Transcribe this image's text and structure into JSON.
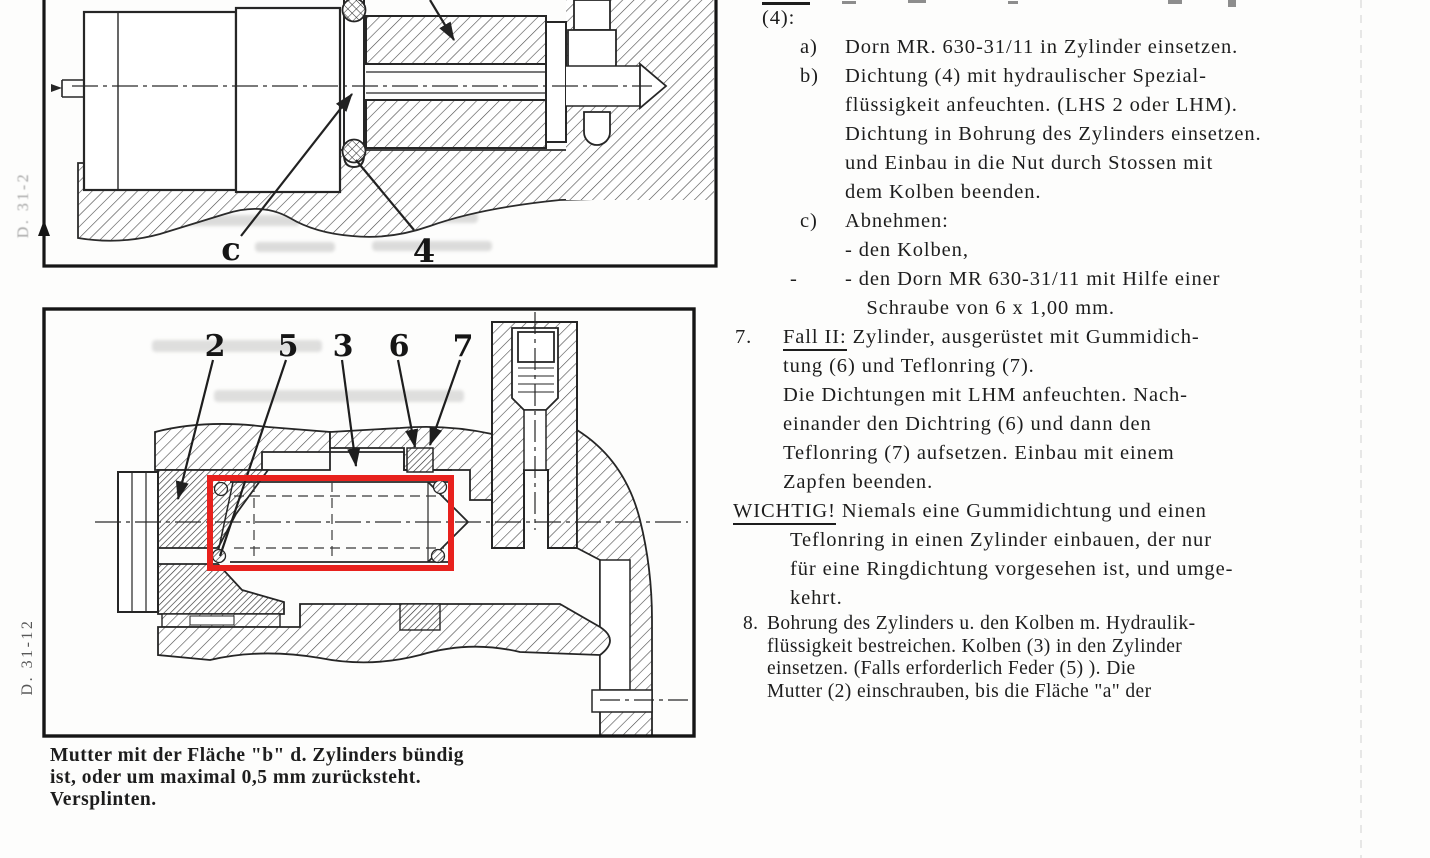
{
  "margin_labels": {
    "top": "D. 31-2",
    "bottom": "D. 31-12"
  },
  "figure_top": {
    "part_labels": {
      "c": "c",
      "four": "4"
    }
  },
  "figure_bottom": {
    "callouts": [
      "2",
      "5",
      "3",
      "6",
      "7"
    ],
    "highlight_color": "#e8211d"
  },
  "caption": {
    "lines": [
      "Mutter mit der Fläche \"b\" d. Zylinders bündig",
      "ist, oder um maximal 0,5 mm zurücksteht.",
      "Versplinten."
    ]
  },
  "text_column": {
    "blocks": [
      {
        "style": "s-cont",
        "marker": "",
        "lines": [
          "(4):"
        ]
      },
      {
        "style": "s-abc",
        "marker": "a)",
        "lines": [
          "Dorn MR. 630-31/11 in Zylinder einsetzen."
        ]
      },
      {
        "style": "s-abc",
        "marker": "b)",
        "lines": [
          "Dichtung (4) mit hydraulischer Spezial-",
          "flüssigkeit anfeuchten. (LHS 2 oder LHM).",
          "Dichtung in Bohrung des Zylinders einsetzen.",
          "und Einbau in die Nut durch Stossen mit",
          "dem Kolben beenden."
        ]
      },
      {
        "style": "s-abc",
        "marker": "c)",
        "lines": [
          "Abnehmen:",
          "- den Kolben,"
        ]
      },
      {
        "style": "s-dash",
        "marker": "-",
        "lines": [
          "- den Dorn MR 630-31/11 mit Hilfe einer",
          " Schraube von 6 x 1,00 mm."
        ]
      },
      {
        "style": "s-n7",
        "marker": "7.",
        "head": "Fall II:",
        "lines": [
          " Zylinder,  ausgerüstet mit Gummidich-",
          "tung (6) und Teflonring (7).",
          "Die Dichtungen mit LHM anfeuchten.  Nach-",
          "einander den Dichtring (6) und dann den",
          "Teflonring (7) aufsetzen.  Einbau mit einem",
          "Zapfen beenden."
        ]
      },
      {
        "style": "s-wichtig",
        "marker": "",
        "head": "WICHTIG!",
        "lines": [
          " Niemals eine Gummidichtung und einen",
          "Teflonring in einen Zylinder einbauen,  der nur",
          "für eine Ringdichtung vorgesehen ist,  und umge-",
          "kehrt."
        ]
      },
      {
        "style": "s-n8",
        "marker": "8.",
        "lines": [
          "Bohrung des Zylinders u. den Kolben m. Hydraulik-",
          "flüssigkeit bestreichen. Kolben (3) in den Zylinder",
          "einsetzen.  (Falls erforderlich Feder (5) ).  Die",
          "Mutter (2) einschrauben, bis die Fläche \"a\" der"
        ]
      }
    ]
  }
}
